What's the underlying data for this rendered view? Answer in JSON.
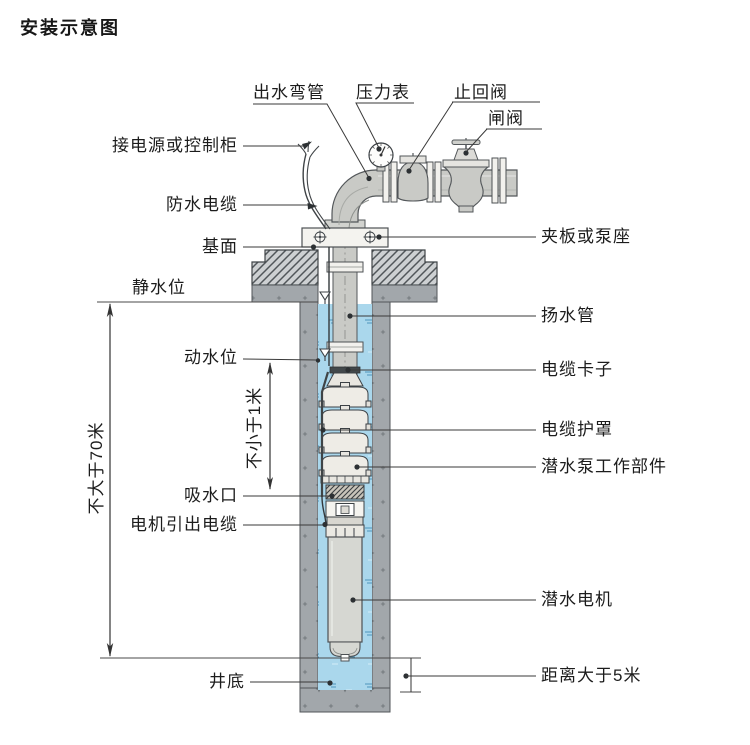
{
  "title": "安装示意图",
  "diagram": {
    "top_labels": {
      "outlet_elbow": "出水弯管",
      "pressure_gauge": "压力表",
      "check_valve": "止回阀",
      "gate_valve": "闸阀"
    },
    "left_labels": {
      "power_or_control_cabinet": "接电源或控制柜",
      "waterproof_cable": "防水电缆",
      "base_surface": "基面",
      "static_water_level": "静水位",
      "dynamic_water_level": "动水位",
      "suction_inlet": "吸水口",
      "motor_lead_cable": "电机引出电缆",
      "well_bottom": "井底"
    },
    "right_labels": {
      "clamp_or_pump_seat": "夹板或泵座",
      "riser_pipe": "扬水管",
      "cable_clamp": "电缆卡子",
      "cable_guard": "电缆护罩",
      "pump_working_parts": "潜水泵工作部件",
      "submersible_motor": "潜水电机",
      "bottom_distance": "距离大于5米"
    },
    "dimension_labels": {
      "max_depth": "不大于70米",
      "min_submergence": "不小于1米"
    },
    "colors": {
      "water": "#aad7ec",
      "casing": "#a2a7ab",
      "pipe": "#c9cac6",
      "line": "#3a3a3a"
    }
  }
}
